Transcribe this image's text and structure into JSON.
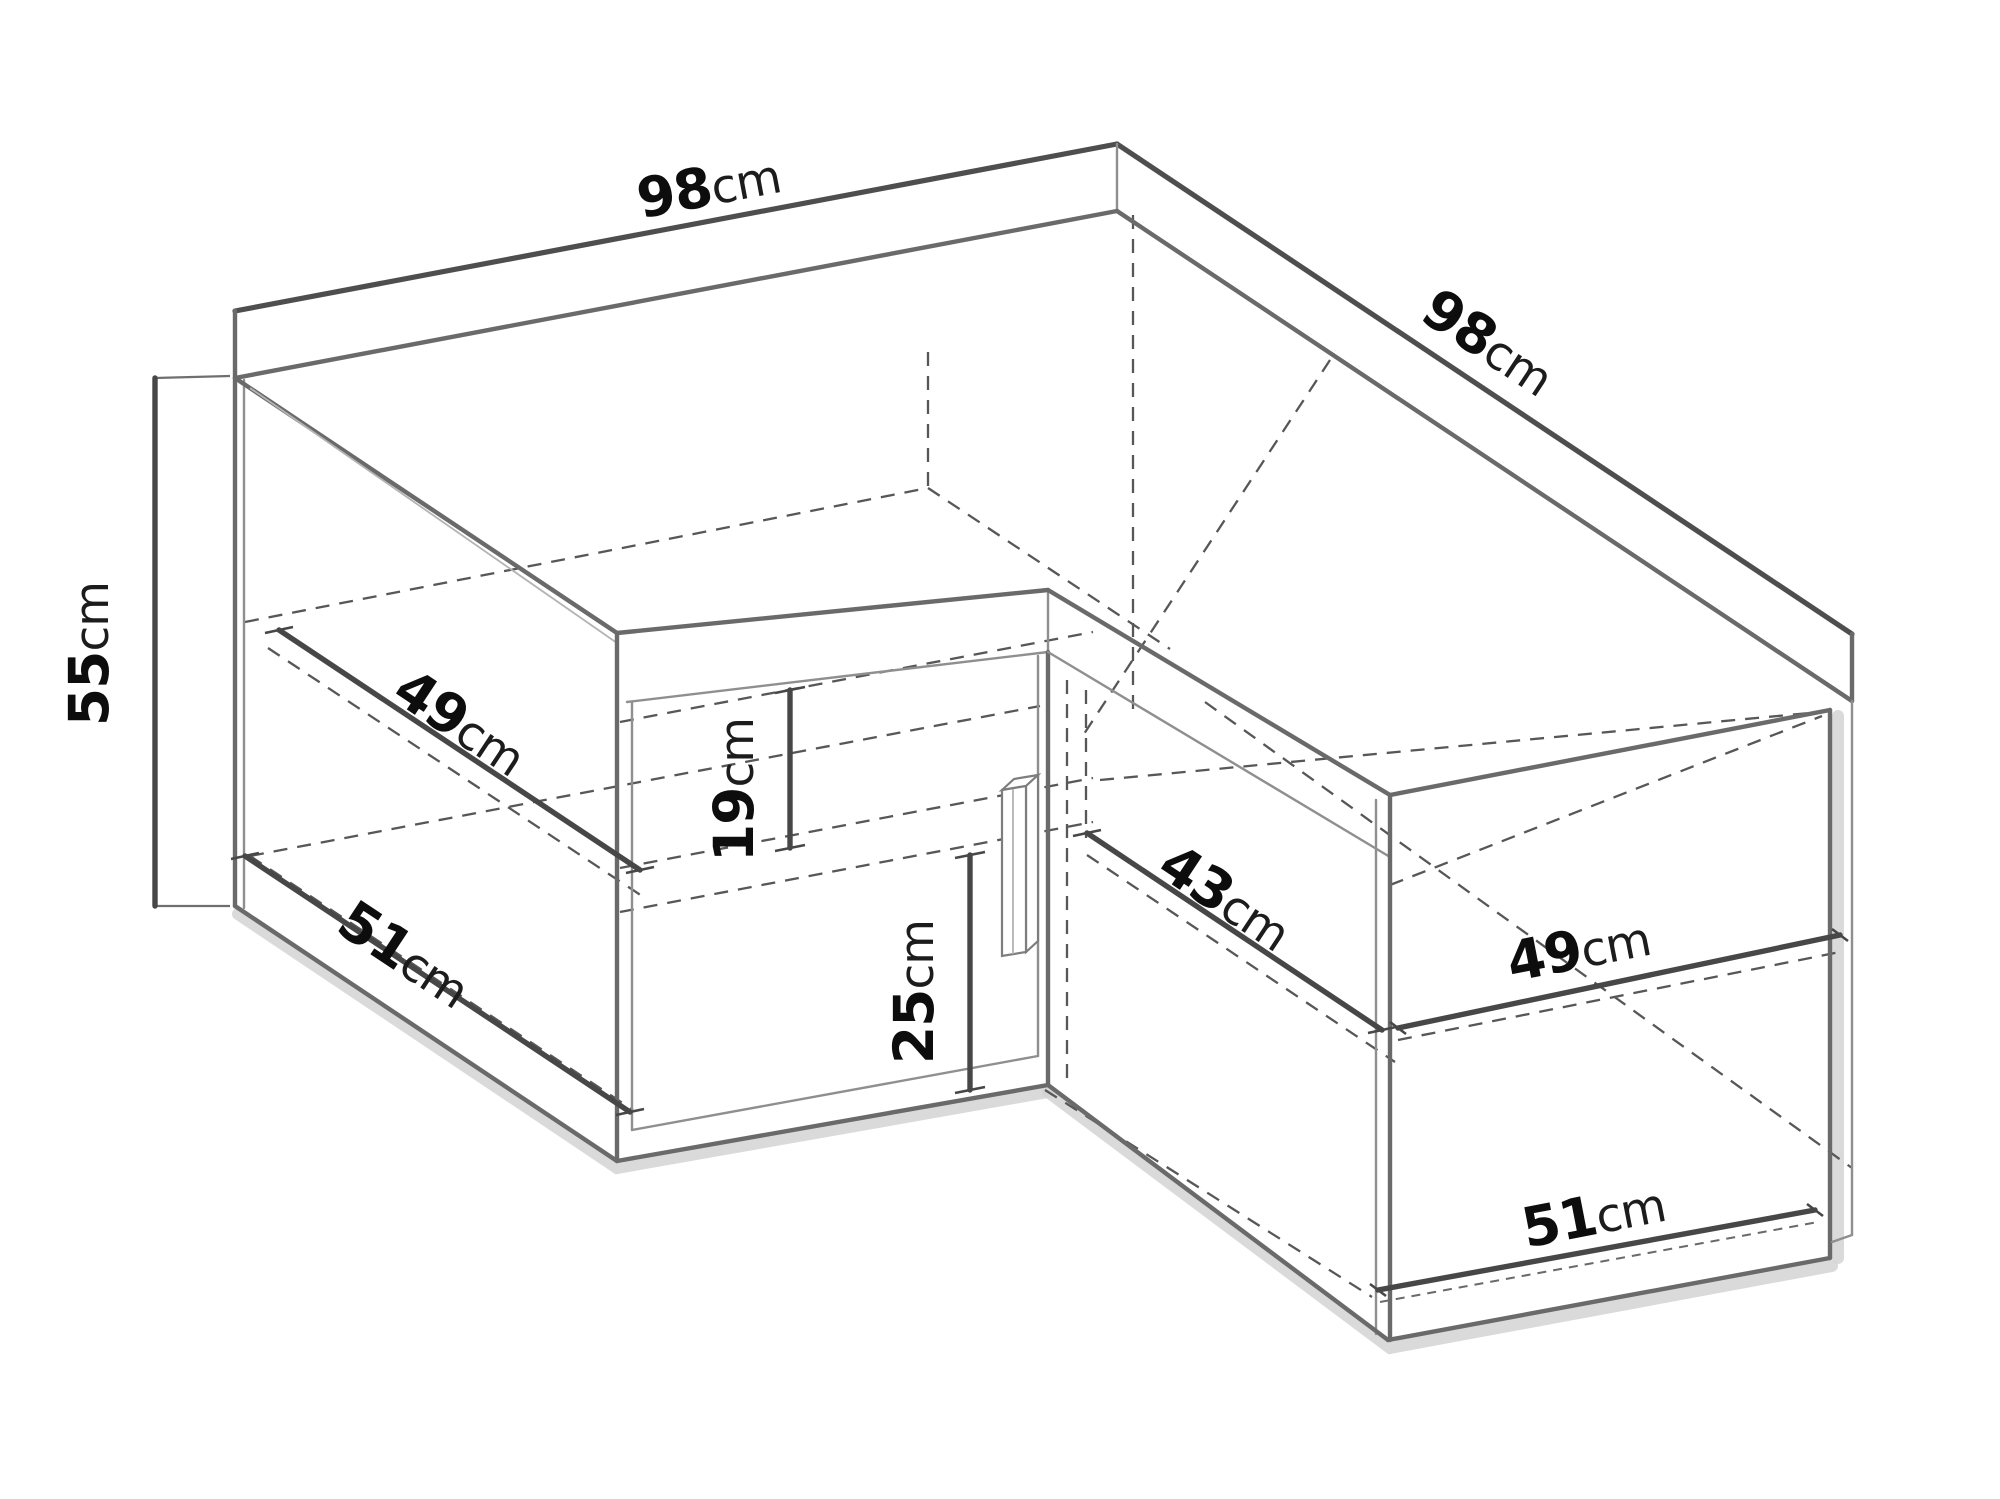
{
  "diagram": {
    "unit": "cm",
    "background": "#ffffff",
    "line_color": "#6a6a6a",
    "dashed_color": "#575757",
    "dimension_line_color": "#474747",
    "text_color": "#0d0d0d",
    "dimensions": {
      "back_width_left": {
        "value": "98",
        "unit": "cm"
      },
      "back_width_right": {
        "value": "98",
        "unit": "cm"
      },
      "height": {
        "value": "55",
        "unit": "cm"
      },
      "shelf_depth_left": {
        "value": "49",
        "unit": "cm"
      },
      "bottom_depth_left": {
        "value": "51",
        "unit": "cm"
      },
      "upper_opening_height": {
        "value": "19",
        "unit": "cm"
      },
      "lower_opening_height": {
        "value": "25",
        "unit": "cm"
      },
      "inner_depth_right": {
        "value": "43",
        "unit": "cm"
      },
      "shelf_width_right": {
        "value": "49",
        "unit": "cm"
      },
      "bottom_width_right": {
        "value": "51",
        "unit": "cm"
      }
    }
  }
}
